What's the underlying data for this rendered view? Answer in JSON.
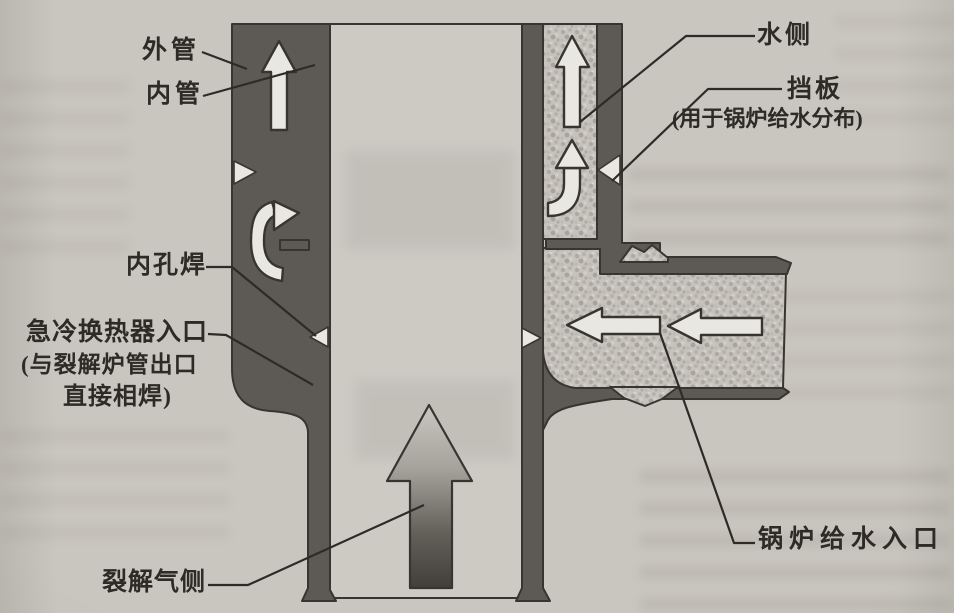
{
  "figure": {
    "labels": {
      "outer_tube": "外管",
      "inner_tube": "内管",
      "water_side": "水侧",
      "baffle": "挡板",
      "baffle_note": "(用于锅炉给水分布)",
      "inner_bore_weld": "内孔焊",
      "quench_inlet_line1": "急冷换热器入口",
      "quench_inlet_line2": "(与裂解炉管出口",
      "quench_inlet_line3": "直接相焊)",
      "boiler_feedwater_inlet": "锅炉给水入口",
      "cracked_gas_side": "裂解气侧"
    },
    "colors": {
      "page_background": "#c9c6bf",
      "metal_wall": "#5d5954",
      "outline": "#38342f",
      "water_fill": "#c6c3bc",
      "gas_fill": "#cdcac4",
      "arrow_fill": "#e9e7e2",
      "label_text": "#2e2b27"
    }
  }
}
